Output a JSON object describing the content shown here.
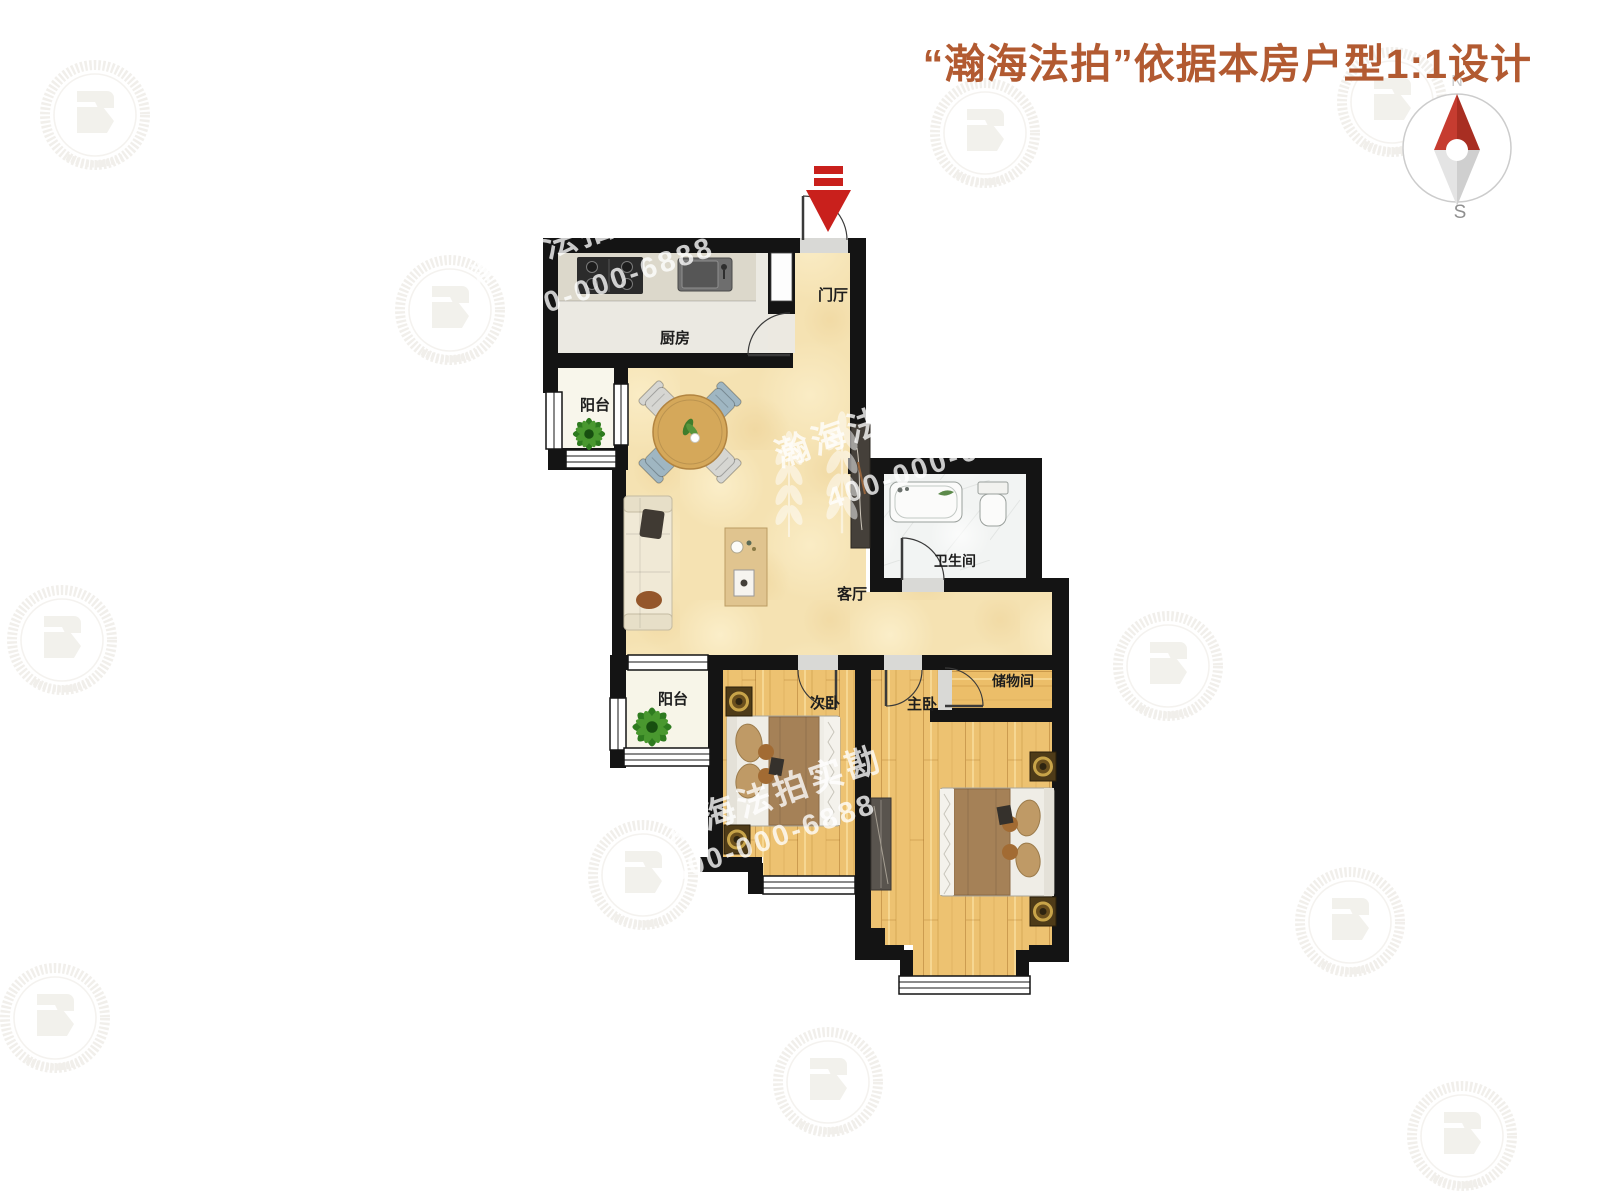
{
  "header": {
    "title": "“瀚海法拍”依据本房户型1:1设计"
  },
  "compass": {
    "north": "N",
    "south": "S"
  },
  "rooms": {
    "kitchen": "厨房",
    "entry": "门厅",
    "balcony_upper": "阳台",
    "living": "客厅",
    "bathroom": "卫生间",
    "balcony_lower": "阳台",
    "bedroom_second": "次卧",
    "bedroom_master": "主卧",
    "storage": "储物间"
  },
  "watermark": {
    "brand": "瀚海法拍实勘",
    "phone": "400-000-6888"
  },
  "colors": {
    "title": "#b25a31",
    "wall": "#141414",
    "marble_floor": "#f5e2b2",
    "wood_floor": "#edc271",
    "compass_north": "#c63c30",
    "entry_arrow": "#c9201c"
  }
}
